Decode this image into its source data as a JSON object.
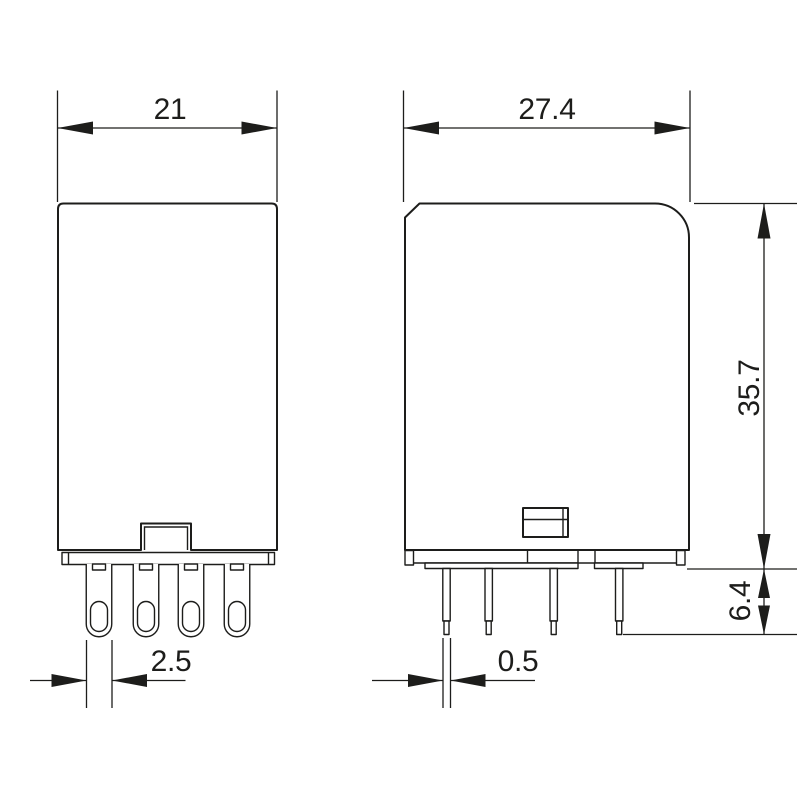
{
  "drawing": {
    "type": "technical-dimension-drawing",
    "background": "#ffffff",
    "line_color": "#1d1d1b",
    "views": {
      "front": {
        "dims": {
          "body_width": "21",
          "pin_width": "2.5"
        }
      },
      "side": {
        "dims": {
          "body_depth": "27.4",
          "body_height": "35.7",
          "pin_length": "6.4",
          "pin_thickness": "0.5"
        }
      }
    }
  }
}
